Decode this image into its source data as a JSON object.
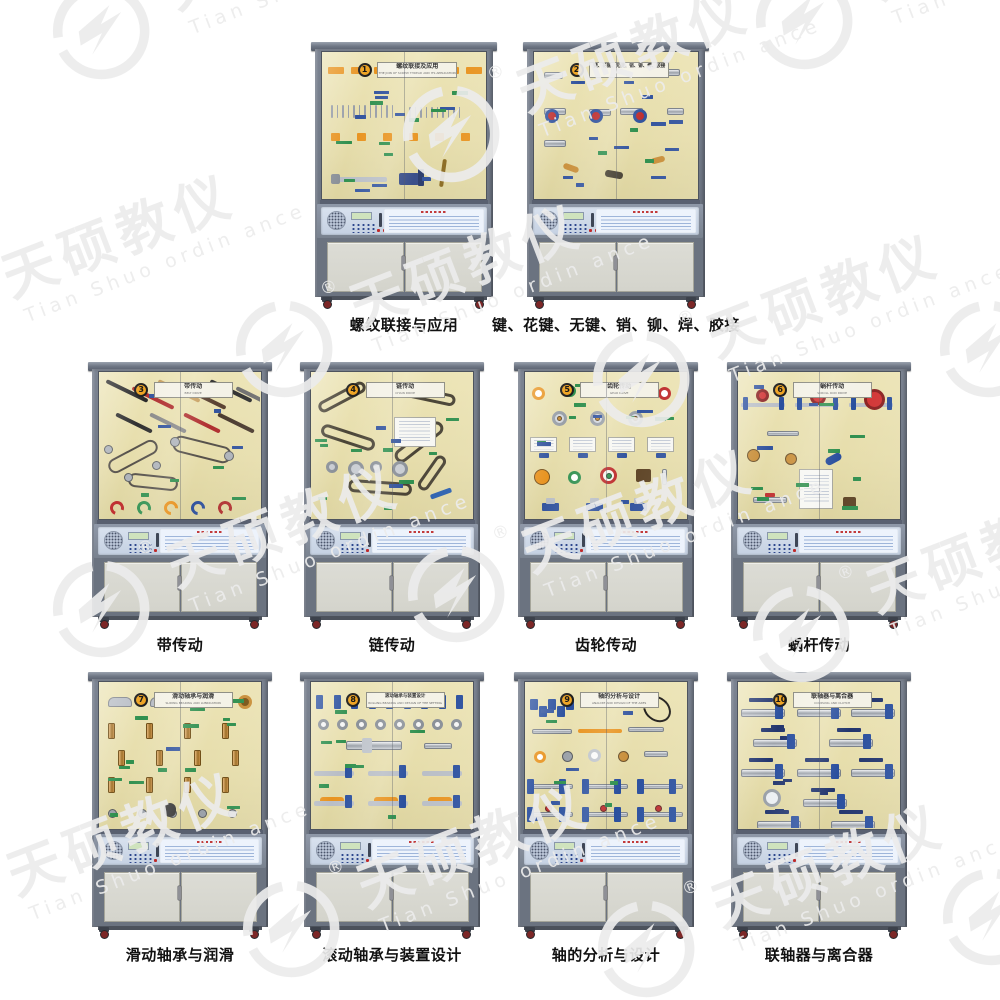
{
  "watermark": {
    "brand": "天硕教仪",
    "latin": "Tian Shuo ordin ance",
    "registered": "®"
  },
  "cabinets": [
    {
      "number": "1",
      "title": "螺纹联接及应用",
      "subtitle_en": "THE JOIN OF SCREW THREAD AND ITS APPLICATION",
      "caption": "螺纹联接与应用",
      "decor": "bolts"
    },
    {
      "number": "2",
      "title": "键、花键、无键、销、铆、焊、胶接",
      "subtitle_en": "",
      "caption": "键、花键、无键、销、铆、焊、胶接",
      "decor": "keys"
    },
    {
      "number": "3",
      "title": "带传动",
      "subtitle_en": "BELT DRIVE",
      "caption": "带传动",
      "decor": "belts"
    },
    {
      "number": "4",
      "title": "链传动",
      "subtitle_en": "CHAIN DRIVE",
      "caption": "链传动",
      "decor": "chains"
    },
    {
      "number": "5",
      "title": "齿轮传动",
      "subtitle_en": "GEAR DRIVE",
      "caption": "齿轮传动",
      "decor": "gears"
    },
    {
      "number": "6",
      "title": "蜗杆传动",
      "subtitle_en": "SCROLL ROD DRIVE",
      "caption": "蜗杆传动",
      "decor": "worms"
    },
    {
      "number": "7",
      "title": "滑动轴承与润滑",
      "subtitle_en": "SLIDING BEARING AND LUBRICATION",
      "caption": "滑动轴承与润滑",
      "decor": "bushings"
    },
    {
      "number": "8",
      "title": "滚动轴承与装置设计",
      "subtitle_en": "ROLLING BEARING AND DESIGN OF THE SETTING",
      "caption": "滚动轴承与装置设计",
      "decor": "bearings"
    },
    {
      "number": "9",
      "title": "轴的分析与设计",
      "subtitle_en": "ANALYZE AND DESIGN OF THE AXES",
      "caption": "轴的分析与设计",
      "decor": "shafts"
    },
    {
      "number": "10",
      "title": "联轴器与离合器",
      "subtitle_en": "COUPLING AND CLUTCH",
      "caption": "联轴器与离合器",
      "decor": "couplings"
    }
  ]
}
